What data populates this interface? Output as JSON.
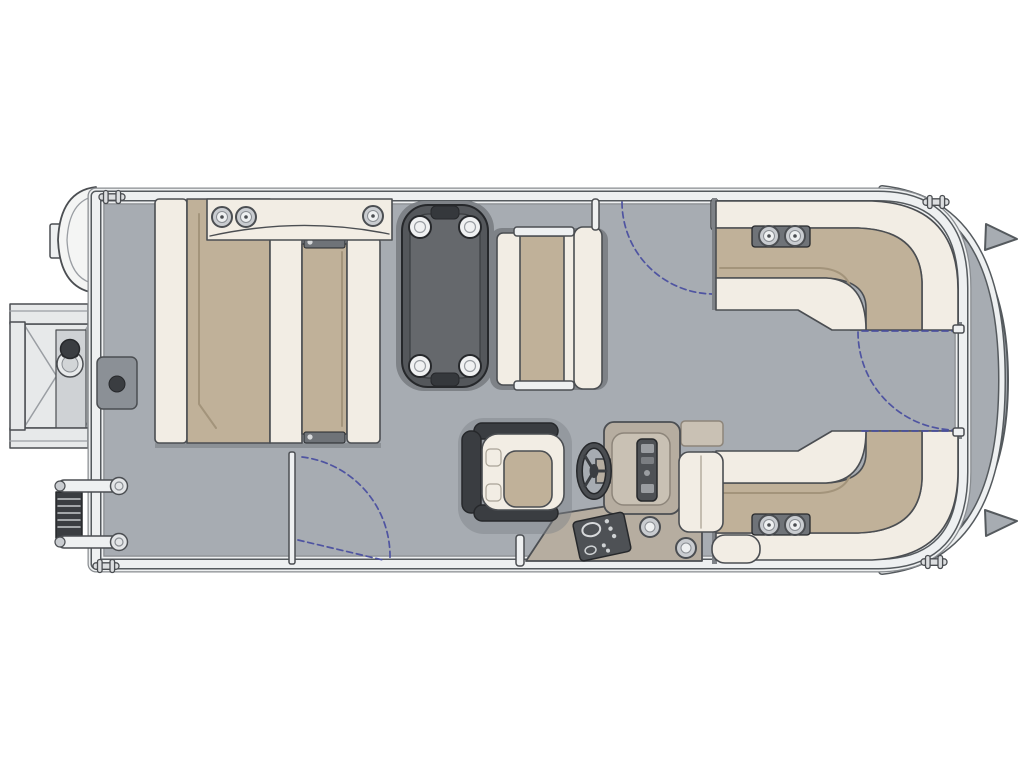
{
  "diagram": {
    "type": "pontoon-boat-floor-plan",
    "view": "top-down",
    "orientation": {
      "bow": "right",
      "stern": "left"
    },
    "parts": [
      "deck",
      "perimeter-fence",
      "rub-rail",
      "bow-nose-cone",
      "nose-fins",
      "mooring-cleats",
      "outboard-motor-pod",
      "swim-platform",
      "ski-tow-pylon",
      "boarding-ladder",
      "deck-latch-pad",
      "facing-chaise-lounges",
      "bow-armrest-console",
      "console-cupholders",
      "cocktail-table",
      "table-cupholders",
      "companion-bench",
      "captains-chair",
      "steering-wheel",
      "helm-console",
      "instrument-cluster",
      "switch-panel",
      "helm-cupholders",
      "copilot-jump-seat",
      "starboard-bow-lounge",
      "port-bow-lounge",
      "lounge-cupholder-armrests",
      "bow-boarding-gate",
      "top-side-gate",
      "port-side-gate",
      "gate-swing-arcs",
      "fence-posts"
    ],
    "counts": {
      "table_cupholders": 4,
      "bow_console_cupholders": 3,
      "lounge_armrest_cupholders_each": 2,
      "helm_cupholders": 2,
      "gates": 3,
      "cleats": 4
    }
  },
  "colors": {
    "bg": "#ffffff",
    "line": "#4b4e52",
    "darker": "#26282b",
    "deck": "#a7acb2",
    "deckEdge": "#555a5e",
    "fenceWhite": "#eef0f1",
    "fenceOuter": "#888c90",
    "cream": "#f2ede4",
    "tan": "#c0b199",
    "tanDark": "#a3947b",
    "shadow": "#7e8287",
    "dark": "#3a3d41",
    "table": "#54575b",
    "tableTop": "#65686c",
    "greige": "#b6ada0",
    "greigeLight": "#c9c1b4",
    "panel": "#4e5155",
    "cupGray": "#c9ccd0",
    "padGray": "#8b9096",
    "gate": "#4a4fa0",
    "platform": "#e7e9ea",
    "platformShade": "#cfd2d5"
  }
}
